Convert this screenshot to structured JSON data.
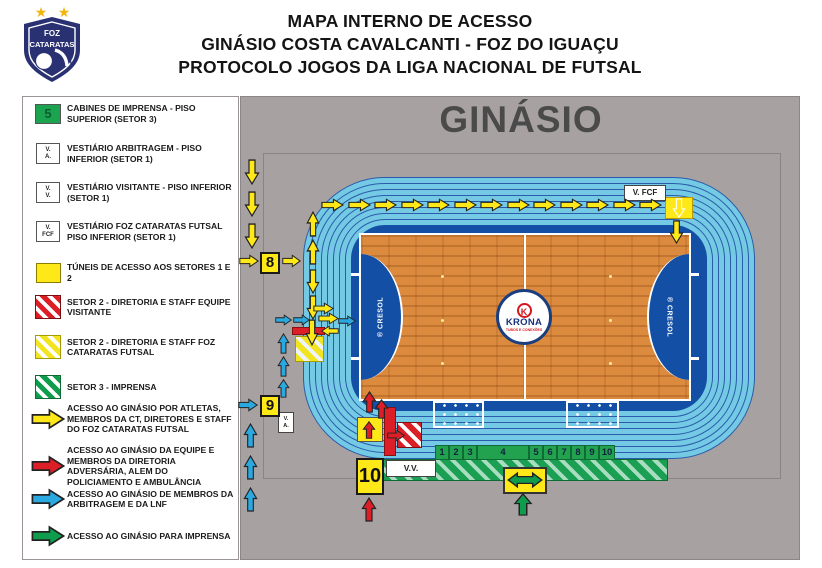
{
  "colors": {
    "yellow": "#FFE817",
    "red": "#DC1F26",
    "blue": "#2AA9E0",
    "green": "#0F9D4D",
    "track_blue": "#74CAE4",
    "pad_blue": "#1350A5",
    "court_orange": "#DC8A3E",
    "panel_gray": "#A7A1A2",
    "section_green": "#22A14E"
  },
  "header": {
    "line1": "MAPA INTERNO DE ACESSO",
    "line2": "GINÁSIO COSTA CAVALCANTI - FOZ DO IGUAÇU",
    "line3": "PROTOCOLO JOGOS DA LIGA NACIONAL DE FUTSAL",
    "logo": {
      "top": "FOZ",
      "bottom": "CATARATAS"
    }
  },
  "legend": {
    "items": [
      {
        "swatch": "5",
        "label": "CABINES DE IMPRENSA - PISO SUPERIOR (SETOR 3)"
      },
      {
        "l1": "V.",
        "l2": "A.",
        "label": "VESTIÁRIO ARBITRAGEM - PISO INFERIOR (SETOR 1)"
      },
      {
        "l1": "V.",
        "l2": "V.",
        "label": "VESTIÁRIO VISITANTE - PISO INFERIOR (SETOR 1)"
      },
      {
        "l1": "V.",
        "l2": "FCF",
        "label": "VESTIÁRIO FOZ CATARATAS FUTSAL PISO INFERIOR (SETOR 1)"
      },
      {
        "label": "TÚNEIS DE ACESSO AOS SETORES 1 E 2"
      },
      {
        "label": "SETOR 2 - DIRETORIA E STAFF EQUIPE VISITANTE"
      },
      {
        "label": "SETOR 2 - DIRETORIA E STAFF FOZ CATARATAS FUTSAL"
      },
      {
        "label": "SETOR 3 - IMPRENSA"
      },
      {
        "label": "ACESSO AO GINÁSIO POR ATLETAS, MEMBROS DA CT, DIRETORES E STAFF DO FOZ CATARATAS FUTSAL"
      },
      {
        "label": "ACESSO AO GINÁSIO DA EQUIPE E MEMBROS DA DIRETORIA ADVERSÁRIA, ALEM DO POLICIAMENTO E AMBULÂNCIA"
      },
      {
        "label": "ACESSO AO GINÁSIO DE MEMBROS DA ARBITRAGEM E DA LNF"
      },
      {
        "label": "ACESSO AO GINÁSIO PARA IMPRENSA"
      }
    ]
  },
  "map": {
    "title": "GINÁSIO",
    "gate8": "8",
    "gate9": "9",
    "gate10": "10",
    "v_fcf": "V. FCF",
    "v_a_l1": "V.",
    "v_a_l2": "A.",
    "v_v": "V.V.",
    "sections": [
      "1",
      "2",
      "3",
      "4",
      "5",
      "6",
      "7",
      "8",
      "9",
      "10"
    ],
    "court": {
      "brand": "KRONA",
      "brand_sub": "TUBOS E CONEXÕES",
      "side_brand": "® CRESOL"
    }
  }
}
